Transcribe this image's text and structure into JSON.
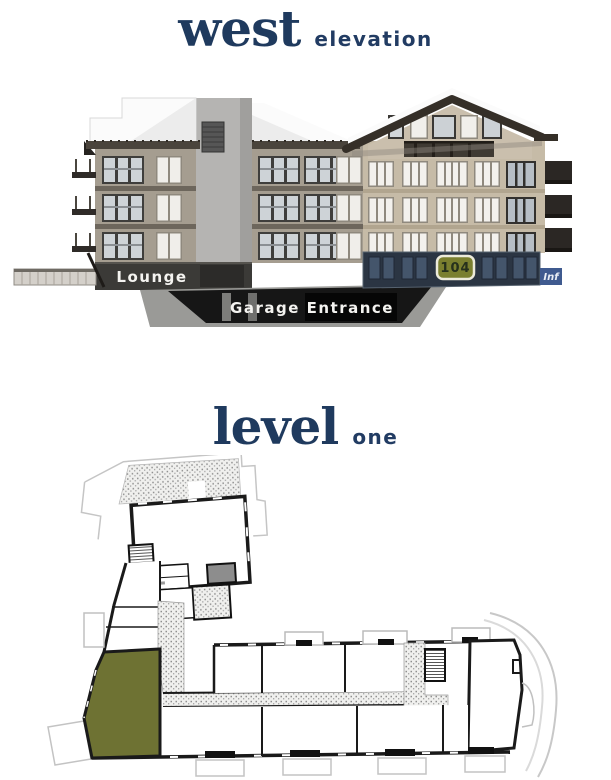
{
  "west_section": {
    "title": "west",
    "subtitle": "elevation",
    "elevation": {
      "lounge_label": "Lounge",
      "garage_label": "Garage Entrance",
      "unit_badge": "104",
      "info_badge": "Inf"
    }
  },
  "level_section": {
    "title": "level",
    "subtitle": "one"
  },
  "colors": {
    "title_navy": "#1f3a5e",
    "badge_olive": "#7a7f2f",
    "badge_border": "#eceada",
    "badge_text": "#26301c",
    "plan_unit_olive": "#6e7233",
    "navy_band": "#2b3543",
    "navy_window": "#44556b",
    "info_blue": "#3f5a8f",
    "wall_tan": "#c6bba7",
    "wall_gray_tan": "#a59d90",
    "fascia_brown": "#3a332b",
    "tower_gray": "#b5b4b2",
    "lounge_dark": "#3b3a37",
    "garage_black": "#161616"
  }
}
